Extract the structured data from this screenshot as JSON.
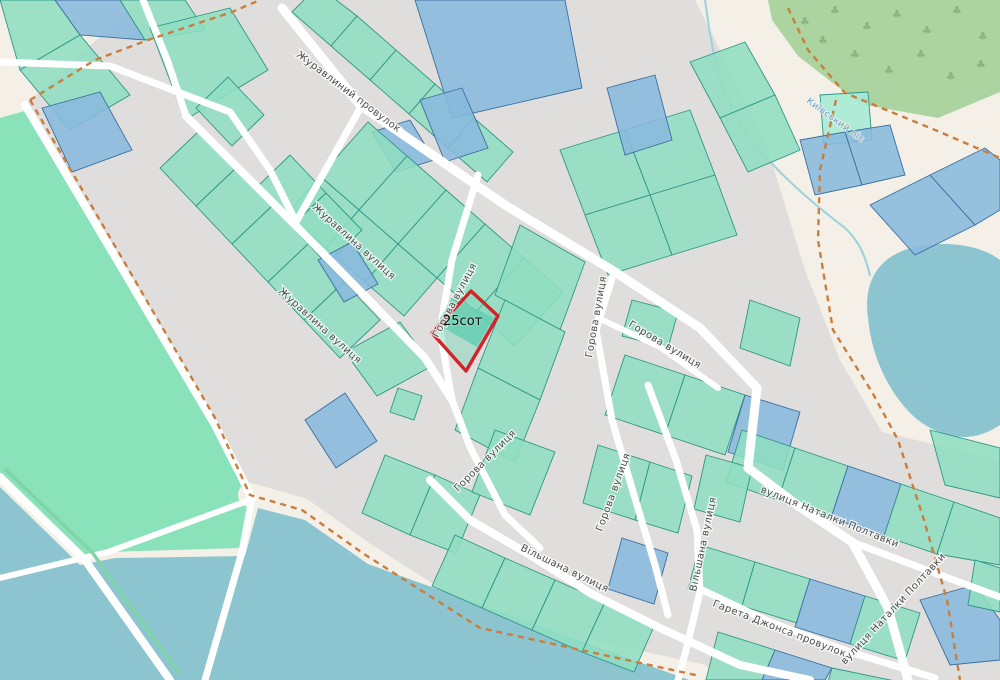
{
  "map": {
    "area_label": {
      "text": "25сот"
    },
    "colors": {
      "outside": "#f4f0e7",
      "residential": "#e0dedc",
      "meadow": "#89e2ba",
      "water": "#8cc5d0",
      "forest": "#abd4a0",
      "tree_glyph": "#85b77f",
      "parcel_teal": "#8fdec2",
      "parcel_teal_stroke": "#2e9688",
      "parcel_blue": "#88badd",
      "parcel_blue_stroke": "#3a6fa0",
      "parcel_mint": "#a5ead5",
      "road": "#ffffff",
      "boundary_dash": "#c97e3e",
      "stream": "#9fd3de",
      "treeline": "#7fd4a8",
      "highlight_red": "#d2232a",
      "highlight_inner": "#66cfb2",
      "highlight_fill": "#7fd8bc"
    },
    "regions": {
      "residential": "140,0 695,0 765,140 805,270 840,360 882,432 1000,460 1000,680 430,680 262,505 215,425 120,262 25,105",
      "meadow": "0,118 28,110 120,268 212,422 250,498 240,548 108,552 85,560 0,477",
      "water": "0,487 80,565 115,558 245,556 258,508 305,520 368,564 700,684 0,684",
      "forest": "768,0 1000,0 1000,92 938,118 860,104 798,56 772,20",
      "pond": "M868,318 C862,275 885,252 920,246 C955,240 985,248 1000,260 L1000,425 C975,442 950,440 925,425 C898,408 872,365 868,318 Z",
      "shore_band": "250,495 302,510 364,554 480,628 700,676",
      "stream": "M705,0 C712,50 718,90 745,132 C775,172 815,205 845,228 C860,242 866,258 870,276",
      "treeline": "6,470 92,552 178,672"
    },
    "trees": [
      [
        800,
        25
      ],
      [
        830,
        14
      ],
      [
        862,
        30
      ],
      [
        892,
        18
      ],
      [
        922,
        34
      ],
      [
        952,
        14
      ],
      [
        978,
        40
      ],
      [
        850,
        58
      ],
      [
        884,
        74
      ],
      [
        916,
        58
      ],
      [
        946,
        80
      ],
      [
        976,
        68
      ],
      [
        818,
        44
      ]
    ],
    "roads": [
      {
        "pts": "282,8 360,105 505,205 612,270 700,328 757,388 748,468 800,507 852,542 888,608 908,680",
        "w": 9
      },
      {
        "pts": "852,542 940,575 1000,597",
        "w": 7
      },
      {
        "pts": "186,116 294,224 362,293 425,358 452,400",
        "w": 8
      },
      {
        "pts": "143,0 168,62 186,116",
        "w": 7
      },
      {
        "pts": "362,105 330,162 296,222",
        "w": 7
      },
      {
        "pts": "0,62 110,66 230,112 270,170 296,222",
        "w": 7
      },
      {
        "pts": "478,175 452,260 440,330 452,400 470,447 505,515 540,548",
        "w": 7
      },
      {
        "pts": "430,480 470,520 530,555 590,593 660,628 740,665 810,680",
        "w": 8
      },
      {
        "pts": "648,385 676,460 697,530 700,592 686,650 678,680",
        "w": 7
      },
      {
        "pts": "698,588 770,622 850,652 935,678",
        "w": 7
      },
      {
        "pts": "614,272 596,330 612,420 634,495 655,565 668,615",
        "w": 7
      },
      {
        "pts": "598,318 660,347 718,388",
        "w": 6
      },
      {
        "pts": "25,105 215,425 252,498",
        "w": 8
      },
      {
        "pts": "252,498 242,552 205,680",
        "w": 7
      },
      {
        "pts": "0,477 85,560 170,680",
        "w": 8
      },
      {
        "pts": "0,578 108,552 250,500",
        "w": 6
      }
    ],
    "boundaries": [
      "30,100 215,418 250,495 302,510 364,554 480,628 700,676",
      "30,100 95,60 148,40 232,12 260,0",
      "788,8 808,50 845,93 940,132 1000,158",
      "836,100 820,170 818,240 833,330 872,392 898,440 924,520 947,600 960,680"
    ],
    "parcels": [
      {
        "pts": "0,0 55,0 80,35 20,70",
        "c": "t"
      },
      {
        "pts": "55,0 120,0 145,40 80,35",
        "c": "b"
      },
      {
        "pts": "120,0 185,0 205,30 145,40",
        "c": "t"
      },
      {
        "pts": "20,70 80,35 130,95 70,130",
        "c": "t"
      },
      {
        "pts": "150,28 230,8 268,70 185,120",
        "c": "t"
      },
      {
        "pts": "42,108 100,92 132,150 72,172",
        "c": "b"
      },
      {
        "pts": "292,12 331,46 357,16 318,-14",
        "c": "t"
      },
      {
        "pts": "331,46 370,80 396,50 357,16",
        "c": "t"
      },
      {
        "pts": "370,80 409,114 435,84 396,50",
        "c": "t"
      },
      {
        "pts": "409,114 448,148 474,118 435,84",
        "c": "t"
      },
      {
        "pts": "448,148 487,182 513,152 474,118",
        "c": "t"
      },
      {
        "pts": "415,0 565,0 582,88 452,118",
        "c": "b"
      },
      {
        "pts": "420,100 462,88 488,148 445,162",
        "c": "b"
      },
      {
        "pts": "372,132 410,120 434,160 396,172",
        "c": "b"
      },
      {
        "pts": "368,122 407,156 359,210 320,176",
        "c": "t"
      },
      {
        "pts": "407,156 446,190 398,244 359,210",
        "c": "t"
      },
      {
        "pts": "446,190 485,224 437,278 398,244",
        "c": "t"
      },
      {
        "pts": "485,224 524,258 476,312 437,278",
        "c": "t"
      },
      {
        "pts": "524,258 563,292 515,346 476,312",
        "c": "t"
      },
      {
        "pts": "320,176 359,210 326,248 287,214",
        "c": "t"
      },
      {
        "pts": "359,210 398,244 365,282 326,248",
        "c": "t"
      },
      {
        "pts": "398,244 437,278 404,316 365,282",
        "c": "t"
      },
      {
        "pts": "258,186 294,224 326,193 290,155",
        "c": "t"
      },
      {
        "pts": "294,224 330,261 362,230 326,193",
        "c": "t"
      },
      {
        "pts": "196,108 232,146 264,115 228,77",
        "c": "t"
      },
      {
        "pts": "200,130 236,168 196,206 160,168",
        "c": "t"
      },
      {
        "pts": "236,168 272,206 232,244 196,206",
        "c": "t"
      },
      {
        "pts": "272,206 308,244 268,282 232,244",
        "c": "t"
      },
      {
        "pts": "308,244 344,282 304,320 268,282",
        "c": "t"
      },
      {
        "pts": "344,282 380,320 340,358 304,320",
        "c": "t"
      },
      {
        "pts": "305,420 345,393 377,441 336,468",
        "c": "b"
      },
      {
        "pts": "345,352 400,322 432,366 377,396",
        "c": "t"
      },
      {
        "pts": "398,388 422,396 414,420 390,412",
        "c": "t"
      },
      {
        "pts": "318,260 352,242 378,284 344,302",
        "c": "b"
      },
      {
        "pts": "520,225 585,262 560,330 495,295",
        "c": "t"
      },
      {
        "pts": "505,300 565,332 540,400 478,368",
        "c": "t"
      },
      {
        "pts": "478,368 540,400 515,462 455,430",
        "c": "t"
      },
      {
        "pts": "560,150 625,130 650,195 585,215",
        "c": "t"
      },
      {
        "pts": "625,130 690,110 715,175 650,195",
        "c": "t"
      },
      {
        "pts": "585,215 650,195 672,255 608,275",
        "c": "t"
      },
      {
        "pts": "650,195 715,175 737,235 672,255",
        "c": "t"
      },
      {
        "pts": "607,88 655,75 672,140 625,155",
        "c": "b"
      },
      {
        "pts": "625,355 685,375 665,435 605,415",
        "c": "t"
      },
      {
        "pts": "685,375 745,395 725,455 665,435",
        "c": "t"
      },
      {
        "pts": "745,395 800,412 783,470 728,452",
        "c": "b"
      },
      {
        "pts": "632,300 678,312 668,348 622,336",
        "c": "t"
      },
      {
        "pts": "750,300 800,318 790,366 740,348",
        "c": "t"
      },
      {
        "pts": "690,62 745,42 775,95 720,118",
        "c": "t"
      },
      {
        "pts": "720,118 775,95 800,150 748,172",
        "c": "t"
      },
      {
        "pts": "820,95 868,92 872,140 824,145",
        "c": "m"
      },
      {
        "pts": "800,140 845,132 862,185 815,195",
        "c": "b"
      },
      {
        "pts": "845,132 890,125 905,175 862,185",
        "c": "b"
      },
      {
        "pts": "870,205 930,175 975,225 915,255",
        "c": "b"
      },
      {
        "pts": "930,175 985,148 1000,160 1000,210 975,225",
        "c": "b"
      },
      {
        "pts": "742,430 795,448 778,500 726,482",
        "c": "t"
      },
      {
        "pts": "795,448 848,466 831,518 778,500",
        "c": "t"
      },
      {
        "pts": "848,466 901,484 884,536 831,518",
        "c": "b"
      },
      {
        "pts": "901,484 954,502 937,554 884,536",
        "c": "t"
      },
      {
        "pts": "954,502 1000,518 1000,565 937,554",
        "c": "t"
      },
      {
        "pts": "930,430 1000,448 1000,498 945,485",
        "c": "t"
      },
      {
        "pts": "700,545 755,562 742,606 688,589",
        "c": "t"
      },
      {
        "pts": "755,562 810,579 797,623 742,606",
        "c": "t"
      },
      {
        "pts": "810,579 865,596 850,644 795,627",
        "c": "b"
      },
      {
        "pts": "865,596 920,613 905,661 850,644",
        "c": "t"
      },
      {
        "pts": "718,632 775,650 762,680 706,680",
        "c": "t"
      },
      {
        "pts": "775,650 832,668 825,680 762,680",
        "c": "b"
      },
      {
        "pts": "832,668 900,682 828,682",
        "c": "t"
      },
      {
        "pts": "920,600 975,585 1000,620 1000,660 950,665",
        "c": "b"
      },
      {
        "pts": "975,560 1000,568 1000,612 968,605",
        "c": "t"
      },
      {
        "pts": "598,445 650,462 635,520 583,503",
        "c": "t"
      },
      {
        "pts": "650,462 692,476 678,533 635,520",
        "c": "t"
      },
      {
        "pts": "622,538 668,553 654,604 608,589",
        "c": "b"
      },
      {
        "pts": "706,455 752,468 740,522 694,509",
        "c": "t"
      },
      {
        "pts": "385,455 435,475 410,535 362,513",
        "c": "t"
      },
      {
        "pts": "435,475 480,495 456,553 410,535",
        "c": "t"
      },
      {
        "pts": "495,430 555,452 530,515 472,492",
        "c": "t"
      },
      {
        "pts": "455,535 505,558 482,608 432,586",
        "c": "t"
      },
      {
        "pts": "505,558 555,580 532,630 482,608",
        "c": "t"
      },
      {
        "pts": "555,580 605,602 582,652 532,630",
        "c": "t"
      },
      {
        "pts": "605,602 655,624 634,672 582,652",
        "c": "t"
      }
    ],
    "red_parcel": {
      "outline": "471,291 498,316 466,371 432,333",
      "inner": "452,297 494,318 477,347 437,324"
    },
    "street_labels": [
      {
        "text": "Журавлиний провулок",
        "x": 296,
        "y": 56,
        "rot": 37
      },
      {
        "text": "Журавлина вулиця",
        "x": 312,
        "y": 208,
        "rot": 42
      },
      {
        "text": "Журавлина вулиця",
        "x": 278,
        "y": 292,
        "rot": 42
      },
      {
        "text": "Горова вулиця",
        "x": 438,
        "y": 338,
        "rot": -62
      },
      {
        "text": "Горова вулиця",
        "x": 592,
        "y": 358,
        "rot": -80
      },
      {
        "text": "Горова вулиця",
        "x": 628,
        "y": 326,
        "rot": 31
      },
      {
        "text": "Горова вулиця",
        "x": 458,
        "y": 492,
        "rot": -45
      },
      {
        "text": "Горова вулиця",
        "x": 602,
        "y": 532,
        "rot": -70
      },
      {
        "text": "Вільшана вулиця",
        "x": 520,
        "y": 550,
        "rot": 26
      },
      {
        "text": "Вільшана вулиця",
        "x": 696,
        "y": 592,
        "rot": -78
      },
      {
        "text": "Гарета Джонса провулок",
        "x": 712,
        "y": 606,
        "rot": 21
      },
      {
        "text": "вулиця Наталки Полтавки",
        "x": 760,
        "y": 492,
        "rot": 22
      },
      {
        "text": "вулиця Наталки Полтавки",
        "x": 845,
        "y": 665,
        "rot": -47
      }
    ],
    "water_labels": [
      {
        "text": "Київський ліс",
        "x": 806,
        "y": 102,
        "rot": 36,
        "color": "#6fa3c8"
      }
    ]
  }
}
